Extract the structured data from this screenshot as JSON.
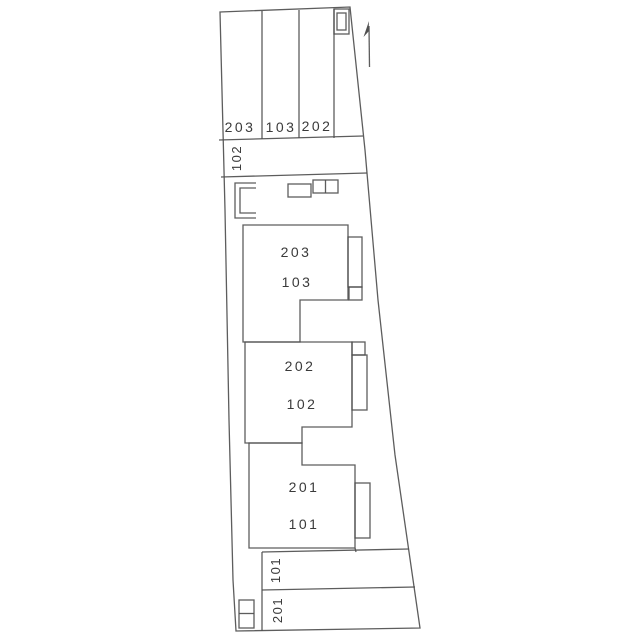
{
  "colors": {
    "paper": "#ffffff",
    "ink": "#4f4f4f",
    "text": "#3a3a3a"
  },
  "plan": {
    "top_stalls": [
      {
        "label": "203"
      },
      {
        "label": "103"
      },
      {
        "label": "202"
      }
    ],
    "side_stall_label": "102",
    "building1": {
      "upper": "203",
      "lower": "103"
    },
    "building2": {
      "upper": "202",
      "lower": "102"
    },
    "building3": {
      "upper": "201",
      "lower": "101"
    },
    "bottom_stalls": [
      {
        "label": "101"
      },
      {
        "label": "201"
      }
    ]
  }
}
